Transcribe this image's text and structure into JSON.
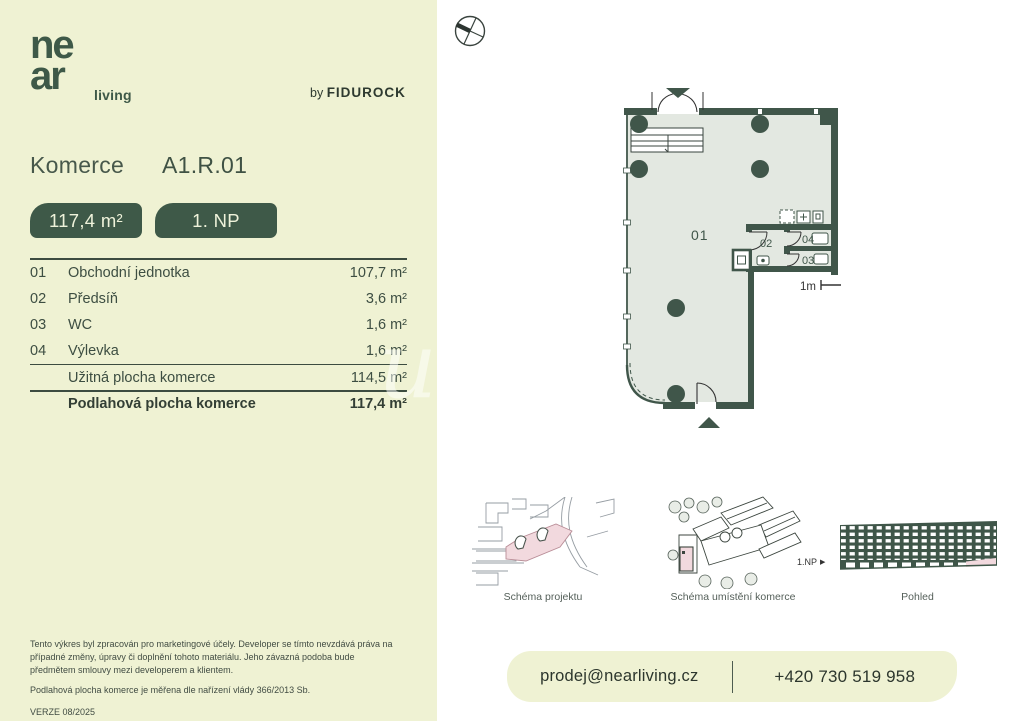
{
  "brand": {
    "logo_line1": "ne",
    "logo_line2": "ar",
    "logo_suffix": "living",
    "byline_prefix": "by",
    "byline_brand": "FIDUROCK"
  },
  "header": {
    "category": "Komerce",
    "unit_id": "A1.R.01"
  },
  "badges": {
    "area": "117,4 m²",
    "floor": "1. NP"
  },
  "rooms": {
    "items": [
      {
        "num": "01",
        "name": "Obchodní jednotka",
        "area": "107,7 m²"
      },
      {
        "num": "02",
        "name": "Předsíň",
        "area": "3,6 m²"
      },
      {
        "num": "03",
        "name": "WC",
        "area": "1,6 m²"
      },
      {
        "num": "04",
        "name": "Výlevka",
        "area": "1,6 m²"
      }
    ],
    "subtotal": {
      "label": "Užitná plocha komerce",
      "value": "114,5 m²"
    },
    "total": {
      "label": "Podlahová plocha komerce",
      "value": "117,4 m²"
    }
  },
  "floorplan": {
    "room01_label": "01",
    "room02_label": "02",
    "room03_label": "03",
    "room04_label": "04",
    "scale_label": "1m"
  },
  "schematics": {
    "project": {
      "caption": "Schéma projektu"
    },
    "location": {
      "caption": "Schéma umístění komerce"
    },
    "elevation": {
      "caption": "Pohled",
      "floor_marker": "1.NP"
    }
  },
  "disclaimer": {
    "paragraph1": "Tento výkres byl zpracován pro marketingové účely. Developer se tímto nevzdává práva na případné změny, úpravy či doplnění tohoto materiálu. Jeho závazná podoba bude předmětem smlouvy mezi developerem a klientem.",
    "paragraph2": "Podlahová plocha komerce je měřena dle nařízení vlády 366/2013 Sb.",
    "version": "VERZE 08/2025"
  },
  "footer": {
    "email": "prodej@nearliving.cz",
    "phone": "+420 730 519 958"
  },
  "colors": {
    "panel": "#eff2d3",
    "accent": "#3e5948",
    "wall": "#40564a",
    "plan_fill": "#e3e8e1",
    "highlight_pink": "#f2d9de"
  }
}
